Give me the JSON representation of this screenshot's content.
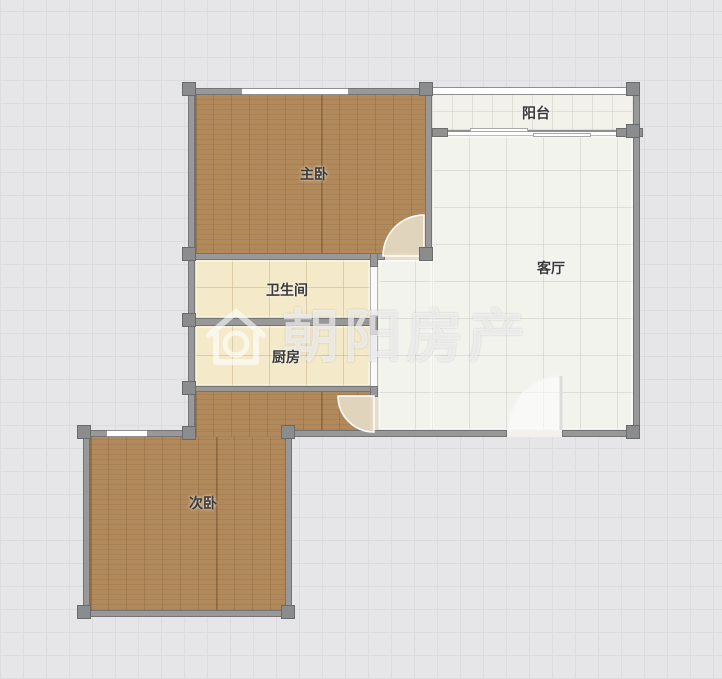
{
  "watermark": {
    "brand_text": "朝阳房产",
    "logo": "house-icon",
    "color": "#ffffff"
  },
  "rooms": [
    {
      "id": "master-bedroom",
      "label": "主卧",
      "floor": "wood"
    },
    {
      "id": "balcony",
      "label": "阳台",
      "floor": "tile"
    },
    {
      "id": "living-room",
      "label": "客厅",
      "floor": "tile"
    },
    {
      "id": "bathroom",
      "label": "卫生间",
      "floor": "cream-tile"
    },
    {
      "id": "kitchen",
      "label": "厨房",
      "floor": "cream-tile"
    },
    {
      "id": "second-bedroom",
      "label": "次卧",
      "floor": "wood"
    }
  ],
  "colors": {
    "wood_floor": "#b1895a",
    "cream_floor": "#f4eac9",
    "tile_floor": "#f3f3ee",
    "wall": "#989898",
    "background": "#e6e6e8",
    "label_text": "#3a3a3a"
  }
}
